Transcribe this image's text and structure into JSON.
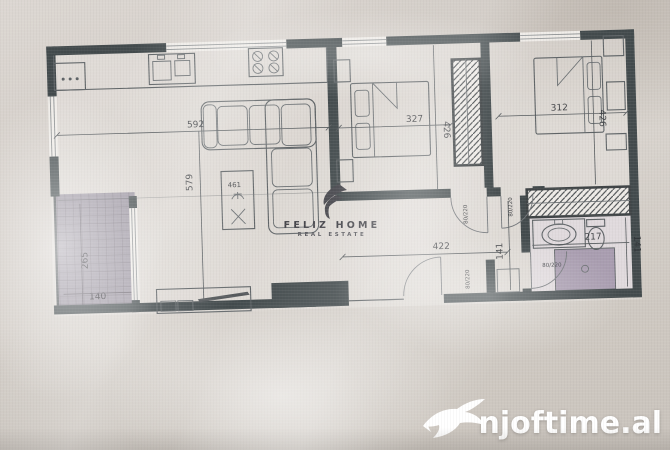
{
  "branding": {
    "name": "FELIZ HOME",
    "tagline": "REAL ESTATE"
  },
  "watermark": {
    "site": "njoftime.al"
  },
  "dimensions": {
    "living_width": "592",
    "living_height": "579",
    "living_label": "461",
    "bedroom1_width": "327",
    "bedroom1_height": "426",
    "bedroom2_width": "312",
    "bedroom2_height": "426",
    "balcony_depth": "265",
    "balcony_width": "140",
    "hall_width": "422",
    "hall_height": "141",
    "bath_width": "217",
    "bath_height": "141"
  },
  "doors": {
    "bedroom1": "80/220",
    "bedroom2": "80/220",
    "bathroom": "80/220",
    "entry": "80/220"
  },
  "colors": {
    "wall": "#424a4c",
    "balcony": "#9b95a1",
    "shower": "#a99db0",
    "watermarkText": "#ffffff",
    "line": "#5e6366"
  }
}
